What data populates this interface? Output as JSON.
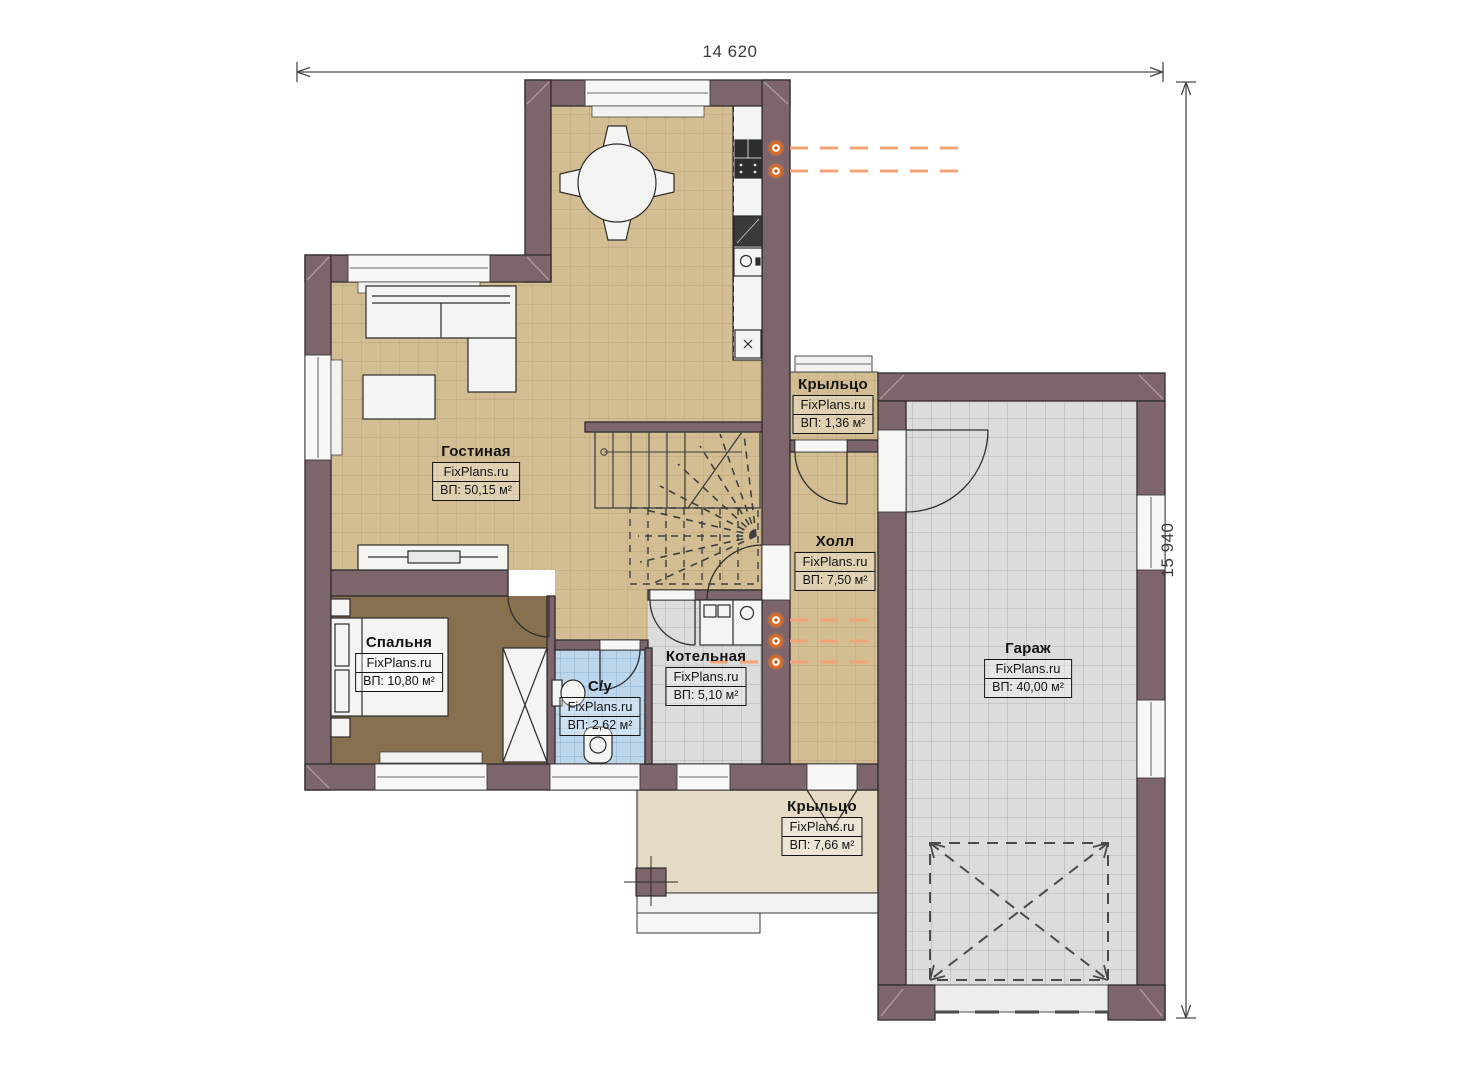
{
  "dimensions": {
    "width": "14 620",
    "height": "15 940"
  },
  "rooms": [
    {
      "name": "Гостиная",
      "brand": "FixPlans.ru",
      "area": "ВП: 50,15 м²"
    },
    {
      "name": "Крыльцо",
      "brand": "FixPlans.ru",
      "area": "ВП: 1,36 м²"
    },
    {
      "name": "Холл",
      "brand": "FixPlans.ru",
      "area": "ВП: 7,50 м²"
    },
    {
      "name": "Гараж",
      "brand": "FixPlans.ru",
      "area": "ВП: 40,00 м²"
    },
    {
      "name": "Спальня",
      "brand": "FixPlans.ru",
      "area": "ВП: 10,80 м²"
    },
    {
      "name": "С/у",
      "brand": "FixPlans.ru",
      "area": "ВП: 2,62 м²"
    },
    {
      "name": "Котельная",
      "brand": "FixPlans.ru",
      "area": "ВП: 5,10 м²"
    },
    {
      "name": "Крыльцо",
      "brand": "FixPlans.ru",
      "area": "ВП: 7,66 м²"
    }
  ],
  "colors": {
    "wall": "#7c666b",
    "floor_tile_tan": "#d3bd93",
    "floor_bedroom": "#87704f",
    "floor_bathroom": "#bcd6ec",
    "floor_garage": "#dcdcda",
    "floor_porch": "#e5dbc4",
    "radiator_orange": "#ed7d31",
    "dimension_line": "#4a4a4a"
  }
}
